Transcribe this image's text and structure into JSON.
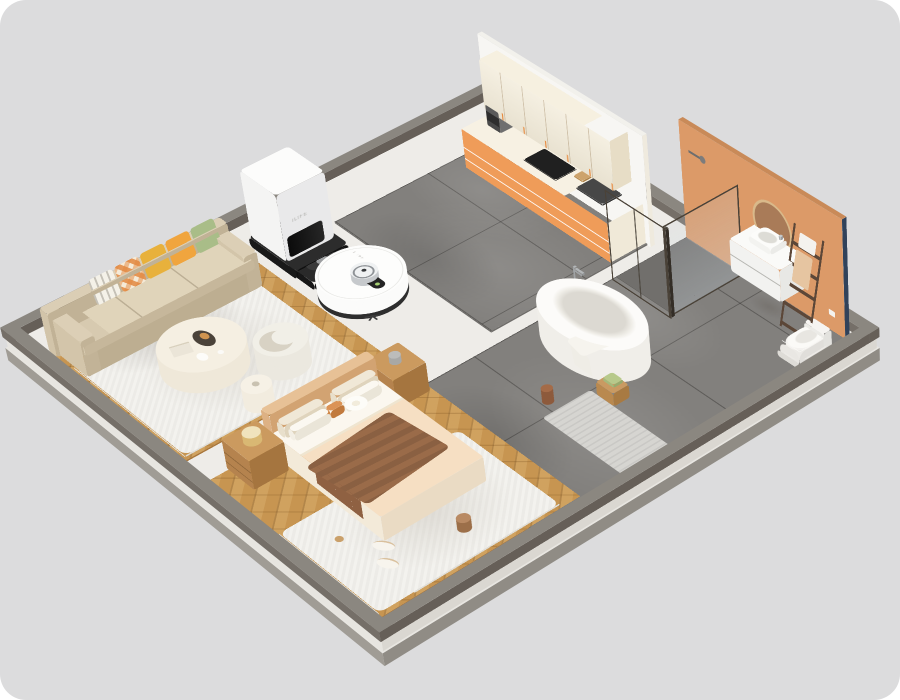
{
  "meta": {
    "description": "Isometric 3D render of an apartment floor plan cleaned by a robot vacuum",
    "background_color": "#dcdcdd",
    "platform_rim_color": "#8b8780",
    "floor_base_color": "#eeece8"
  },
  "robot": {
    "brand": "ILIFE",
    "type": "robot-vacuum",
    "body_color": "#fbfbfa",
    "base_ring_color": "#2e2e2e",
    "lidar_color": "#c6c9cc"
  },
  "dock": {
    "brand": "ILIFE",
    "type": "self-empty-dock",
    "body_color": "#fcfcfb",
    "base_color": "#191919"
  },
  "rooms": {
    "living_room": {
      "floor": "herringbone-oak",
      "wood_color": "#c79551",
      "rug_color": "#f3f2ee",
      "sofa_color": "#d7cab0",
      "items": [
        "three-seat-sofa",
        "throw-pillows",
        "round-coffee-table",
        "curved-armchair",
        "side-table",
        "area-rug"
      ]
    },
    "bedroom": {
      "floor": "herringbone-oak",
      "bedding_color": "#f6dfc3",
      "throw_color": "#9a6b49",
      "items": [
        "double-bed",
        "padded-headboard",
        "nightstand-left",
        "nightstand-right",
        "brass-lamp",
        "area-rug",
        "slippers",
        "throw-blanket"
      ]
    },
    "kitchen": {
      "floor": "grey-marble-tile",
      "wall_color": "#f7f6f3",
      "upper_cabinet_color": "#f2ebd9",
      "lower_cabinet_color": "#ef9c59",
      "items": [
        "upper-cabinets",
        "counter-drawers",
        "induction-cooktop",
        "sink-with-faucet",
        "coffee-machine",
        "cutting-board"
      ]
    },
    "bathroom": {
      "floor": "grey-marble-tile",
      "wall_color": "#dc9a68",
      "wall_edge_color": "#31425a",
      "items": [
        "freestanding-bathtub",
        "floor-faucet",
        "shower-enclosure",
        "vanity-with-basin",
        "round-mirror",
        "towel-ladder",
        "toilet",
        "bath-mat",
        "wooden-stool"
      ]
    }
  }
}
